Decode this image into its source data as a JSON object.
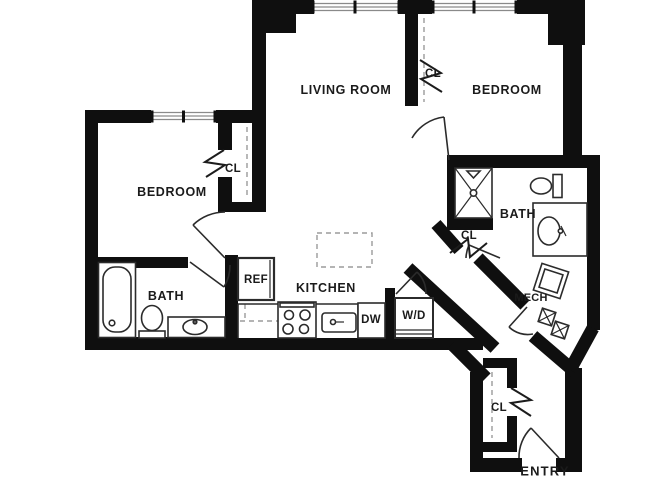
{
  "floor_plan": {
    "colors": {
      "background": "#ffffff",
      "wall": "#0f0f0f",
      "fixture_line": "#2b2b2b",
      "dashed_line": "#9b9b9b",
      "window_line": "#8a8a8a",
      "label_text": "#1b1b1b"
    },
    "labels": {
      "living_room": "LIVING ROOM",
      "bedroom_left": "BEDROOM",
      "bedroom_right": "BEDROOM",
      "bath_left": "BATH",
      "bath_right": "BATH",
      "kitchen": "KITCHEN",
      "mech": "MECH",
      "entry": "ENTRY",
      "closet": "CL",
      "refrigerator": "REF",
      "dishwasher": "DW",
      "washer_dryer": "W/D"
    },
    "icons": [
      "bathtub-icon",
      "toilet-icon",
      "vanity-sink-icon",
      "shower-icon",
      "stove-icon",
      "kitchen-sink-icon",
      "refrigerator-box",
      "washer-dryer-box",
      "water-heater-icon",
      "mech-units-icon",
      "closet-rod-dashed",
      "window-glazing",
      "door-swing",
      "kitchen-island-dashed"
    ]
  }
}
